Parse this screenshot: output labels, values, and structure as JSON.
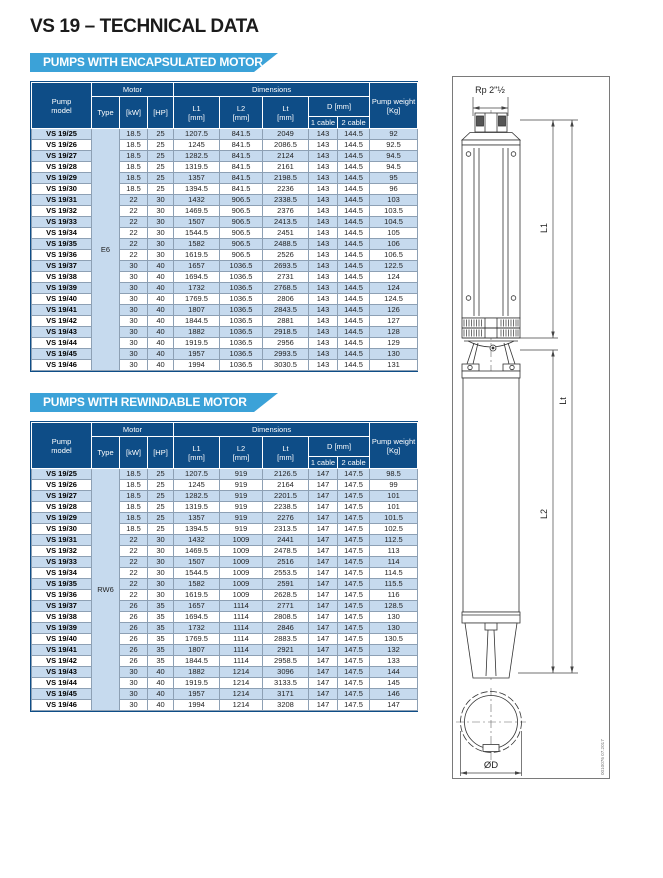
{
  "page": {
    "title": "VS 19 – TECHNICAL DATA",
    "doc_code": "0010076 07.2017"
  },
  "colors": {
    "navy": "#0e4d87",
    "banner_blue": "#3ba2d8",
    "row_shaded": "#c6daee",
    "type_cell": "#bdd3e9"
  },
  "headers": {
    "pump_model": "Pump\nmodel",
    "motor": "Motor",
    "dimensions": "Dimensions",
    "pump_weight": "Pump weight\n[Kg]",
    "type": "Type",
    "kw": "[kW]",
    "hp": "[HP]",
    "l1": "L1\n[mm]",
    "l2": "L2\n[mm]",
    "lt": "Lt\n[mm]",
    "d": "D [mm]",
    "cable1": "1 cable",
    "cable2": "2 cable"
  },
  "tables": [
    {
      "banner": "PUMPS WITH ENCAPSULATED MOTOR",
      "motor_type": "E6",
      "rows": [
        [
          "VS 19/25",
          "18.5",
          "25",
          "1207.5",
          "841.5",
          "2049",
          "143",
          "144.5",
          "92"
        ],
        [
          "VS 19/26",
          "18.5",
          "25",
          "1245",
          "841.5",
          "2086.5",
          "143",
          "144.5",
          "92.5"
        ],
        [
          "VS 19/27",
          "18.5",
          "25",
          "1282.5",
          "841.5",
          "2124",
          "143",
          "144.5",
          "94.5"
        ],
        [
          "VS 19/28",
          "18.5",
          "25",
          "1319.5",
          "841.5",
          "2161",
          "143",
          "144.5",
          "94.5"
        ],
        [
          "VS 19/29",
          "18.5",
          "25",
          "1357",
          "841.5",
          "2198.5",
          "143",
          "144.5",
          "95"
        ],
        [
          "VS 19/30",
          "18.5",
          "25",
          "1394.5",
          "841.5",
          "2236",
          "143",
          "144.5",
          "96"
        ],
        [
          "VS 19/31",
          "22",
          "30",
          "1432",
          "906.5",
          "2338.5",
          "143",
          "144.5",
          "103"
        ],
        [
          "VS 19/32",
          "22",
          "30",
          "1469.5",
          "906.5",
          "2376",
          "143",
          "144.5",
          "103.5"
        ],
        [
          "VS 19/33",
          "22",
          "30",
          "1507",
          "906.5",
          "2413.5",
          "143",
          "144.5",
          "104.5"
        ],
        [
          "VS 19/34",
          "22",
          "30",
          "1544.5",
          "906.5",
          "2451",
          "143",
          "144.5",
          "105"
        ],
        [
          "VS 19/35",
          "22",
          "30",
          "1582",
          "906.5",
          "2488.5",
          "143",
          "144.5",
          "106"
        ],
        [
          "VS 19/36",
          "22",
          "30",
          "1619.5",
          "906.5",
          "2526",
          "143",
          "144.5",
          "106.5"
        ],
        [
          "VS 19/37",
          "30",
          "40",
          "1657",
          "1036.5",
          "2693.5",
          "143",
          "144.5",
          "122.5"
        ],
        [
          "VS 19/38",
          "30",
          "40",
          "1694.5",
          "1036.5",
          "2731",
          "143",
          "144.5",
          "124"
        ],
        [
          "VS 19/39",
          "30",
          "40",
          "1732",
          "1036.5",
          "2768.5",
          "143",
          "144.5",
          "124"
        ],
        [
          "VS 19/40",
          "30",
          "40",
          "1769.5",
          "1036.5",
          "2806",
          "143",
          "144.5",
          "124.5"
        ],
        [
          "VS 19/41",
          "30",
          "40",
          "1807",
          "1036.5",
          "2843.5",
          "143",
          "144.5",
          "126"
        ],
        [
          "VS 19/42",
          "30",
          "40",
          "1844.5",
          "1036.5",
          "2881",
          "143",
          "144.5",
          "127"
        ],
        [
          "VS 19/43",
          "30",
          "40",
          "1882",
          "1036.5",
          "2918.5",
          "143",
          "144.5",
          "128"
        ],
        [
          "VS 19/44",
          "30",
          "40",
          "1919.5",
          "1036.5",
          "2956",
          "143",
          "144.5",
          "129"
        ],
        [
          "VS 19/45",
          "30",
          "40",
          "1957",
          "1036.5",
          "2993.5",
          "143",
          "144.5",
          "130"
        ],
        [
          "VS 19/46",
          "30",
          "40",
          "1994",
          "1036.5",
          "3030.5",
          "143",
          "144.5",
          "131"
        ]
      ]
    },
    {
      "banner": "PUMPS WITH REWINDABLE MOTOR",
      "motor_type": "RW6",
      "rows": [
        [
          "VS 19/25",
          "18.5",
          "25",
          "1207.5",
          "919",
          "2126.5",
          "147",
          "147.5",
          "98.5"
        ],
        [
          "VS 19/26",
          "18.5",
          "25",
          "1245",
          "919",
          "2164",
          "147",
          "147.5",
          "99"
        ],
        [
          "VS 19/27",
          "18.5",
          "25",
          "1282.5",
          "919",
          "2201.5",
          "147",
          "147.5",
          "101"
        ],
        [
          "VS 19/28",
          "18.5",
          "25",
          "1319.5",
          "919",
          "2238.5",
          "147",
          "147.5",
          "101"
        ],
        [
          "VS 19/29",
          "18.5",
          "25",
          "1357",
          "919",
          "2276",
          "147",
          "147.5",
          "101.5"
        ],
        [
          "VS 19/30",
          "18.5",
          "25",
          "1394.5",
          "919",
          "2313.5",
          "147",
          "147.5",
          "102.5"
        ],
        [
          "VS 19/31",
          "22",
          "30",
          "1432",
          "1009",
          "2441",
          "147",
          "147.5",
          "112.5"
        ],
        [
          "VS 19/32",
          "22",
          "30",
          "1469.5",
          "1009",
          "2478.5",
          "147",
          "147.5",
          "113"
        ],
        [
          "VS 19/33",
          "22",
          "30",
          "1507",
          "1009",
          "2516",
          "147",
          "147.5",
          "114"
        ],
        [
          "VS 19/34",
          "22",
          "30",
          "1544.5",
          "1009",
          "2553.5",
          "147",
          "147.5",
          "114.5"
        ],
        [
          "VS 19/35",
          "22",
          "30",
          "1582",
          "1009",
          "2591",
          "147",
          "147.5",
          "115.5"
        ],
        [
          "VS 19/36",
          "22",
          "30",
          "1619.5",
          "1009",
          "2628.5",
          "147",
          "147.5",
          "116"
        ],
        [
          "VS 19/37",
          "26",
          "35",
          "1657",
          "1114",
          "2771",
          "147",
          "147.5",
          "128.5"
        ],
        [
          "VS 19/38",
          "26",
          "35",
          "1694.5",
          "1114",
          "2808.5",
          "147",
          "147.5",
          "130"
        ],
        [
          "VS 19/39",
          "26",
          "35",
          "1732",
          "1114",
          "2846",
          "147",
          "147.5",
          "130"
        ],
        [
          "VS 19/40",
          "26",
          "35",
          "1769.5",
          "1114",
          "2883.5",
          "147",
          "147.5",
          "130.5"
        ],
        [
          "VS 19/41",
          "26",
          "35",
          "1807",
          "1114",
          "2921",
          "147",
          "147.5",
          "132"
        ],
        [
          "VS 19/42",
          "26",
          "35",
          "1844.5",
          "1114",
          "2958.5",
          "147",
          "147.5",
          "133"
        ],
        [
          "VS 19/43",
          "30",
          "40",
          "1882",
          "1214",
          "3096",
          "147",
          "147.5",
          "144"
        ],
        [
          "VS 19/44",
          "30",
          "40",
          "1919.5",
          "1214",
          "3133.5",
          "147",
          "147.5",
          "145"
        ],
        [
          "VS 19/45",
          "30",
          "40",
          "1957",
          "1214",
          "3171",
          "147",
          "147.5",
          "146"
        ],
        [
          "VS 19/46",
          "30",
          "40",
          "1994",
          "1214",
          "3208",
          "147",
          "147.5",
          "147"
        ]
      ]
    }
  ],
  "diagram": {
    "port_label": "Rp 2\"½",
    "dim_l1": "L1",
    "dim_l2": "L2",
    "dim_lt": "Lt",
    "dim_d": "ØD"
  }
}
